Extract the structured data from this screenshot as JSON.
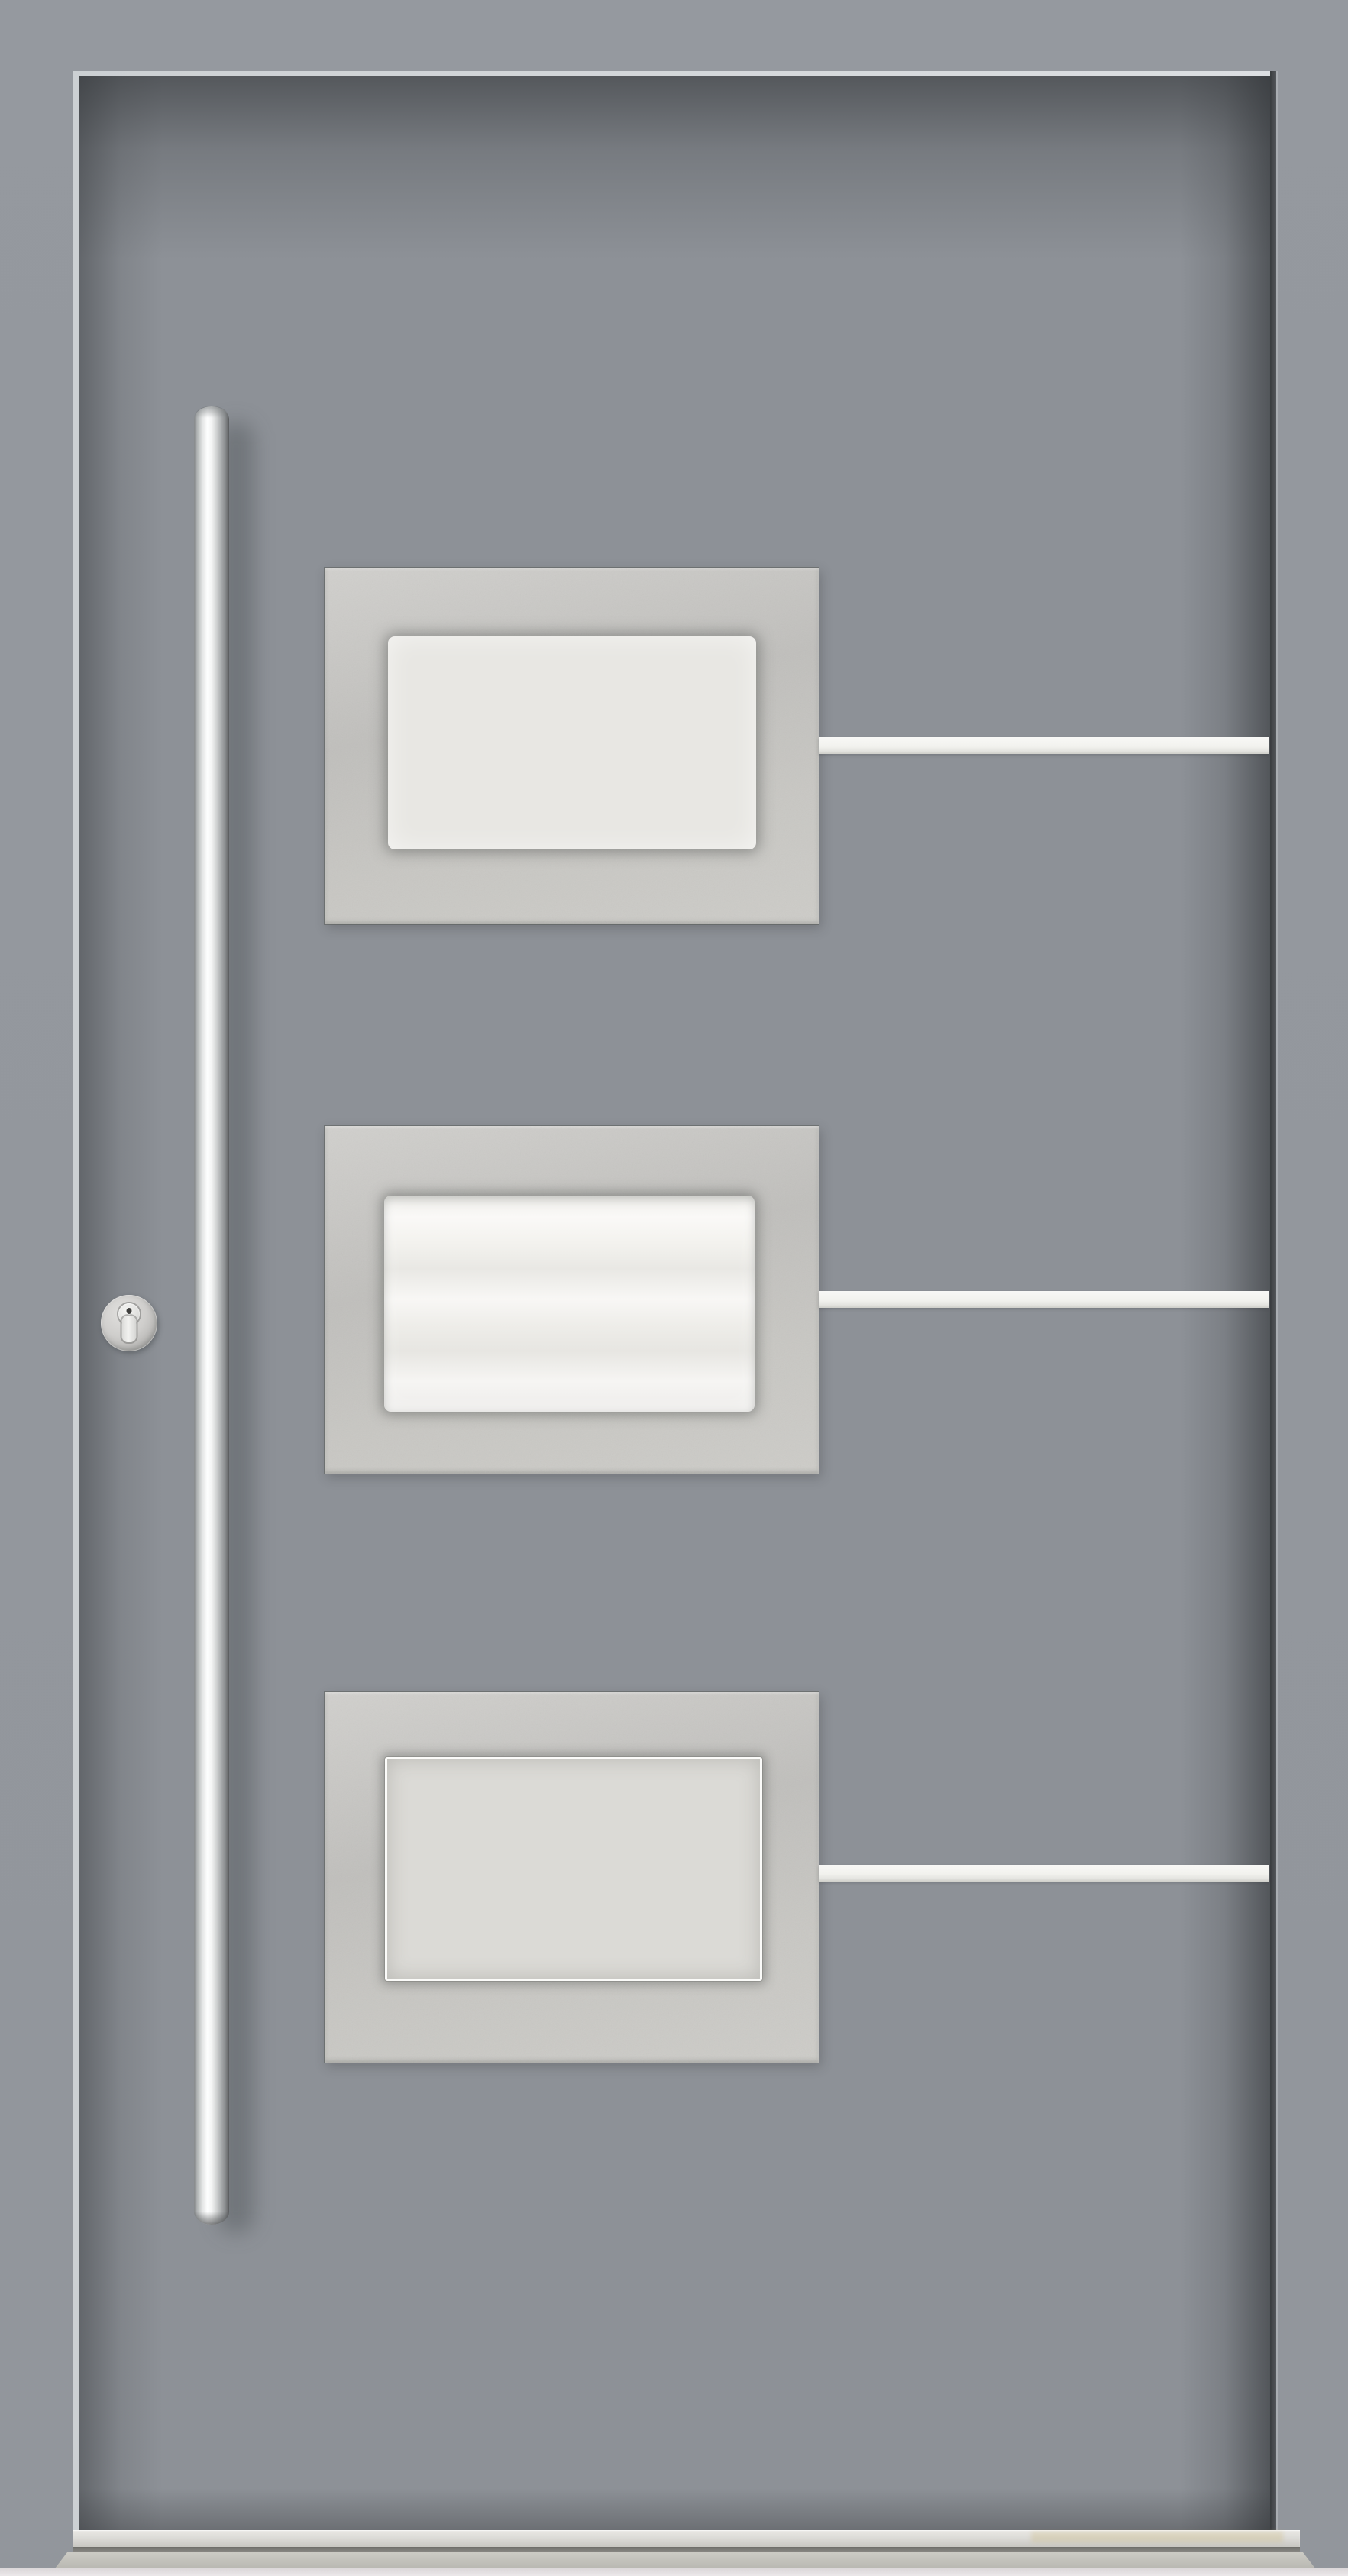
{
  "meta": {
    "description": "Exterior product view of a modern gray aluminium entrance door with a tall stainless-steel bar pull handle, a round cylinder lock rosette, three brushed stainless glazing plates with frosted glass and three horizontal white inlay stripes, above a metal threshold sill.",
    "scene": "front-entry-door",
    "view": "straight-on exterior",
    "text_content": "none"
  },
  "door": {
    "leaf": {
      "label": "door-leaf",
      "color": "#8d9197"
    },
    "frame": {
      "label": "door-frame",
      "color": "#93979d"
    },
    "reveal_highlight_color": "#d6d9dc",
    "rebate_gap_color": "#45484b"
  },
  "hardware": {
    "pull_handle": {
      "label": "vertical-bar-pull-handle",
      "finish": "polished stainless steel",
      "orientation": "vertical",
      "highlight_color": "#fdfefe",
      "shade_color": "#595b5d"
    },
    "lock": {
      "label": "euro-cylinder-lock-rosette",
      "finish": "stainless steel",
      "rosette_color": "#c6c5c3",
      "cylinder_color": "#eeeeec",
      "keyhole_color": "#3e3e3c"
    }
  },
  "glazing_panels": {
    "count": 3,
    "plate_finish": "brushed stainless steel",
    "plate_color": "#c6c5c1",
    "items": [
      {
        "position": "top",
        "glass_style": "frosted, soft recess shadow",
        "glass_color": "#e8e7e3"
      },
      {
        "position": "middle",
        "glass_style": "frosted with bright horizontal reflections",
        "glass_color": "#f4f3f0"
      },
      {
        "position": "bottom",
        "glass_style": "frosted with thin white border frame",
        "glass_color": "#dbdad6",
        "border_color": "#fbfbf9"
      }
    ]
  },
  "inlay_stripes": {
    "count": 3,
    "orientation": "horizontal",
    "color": "#f1f1ed",
    "positions": [
      "level with top panel",
      "level with middle panel",
      "level with bottom panel"
    ]
  },
  "threshold": {
    "sill_color": "#d9d8d4",
    "shadow_color": "#7c7c78",
    "base_color": "#c3c2bc",
    "floor_color": "#e9e5e7"
  }
}
